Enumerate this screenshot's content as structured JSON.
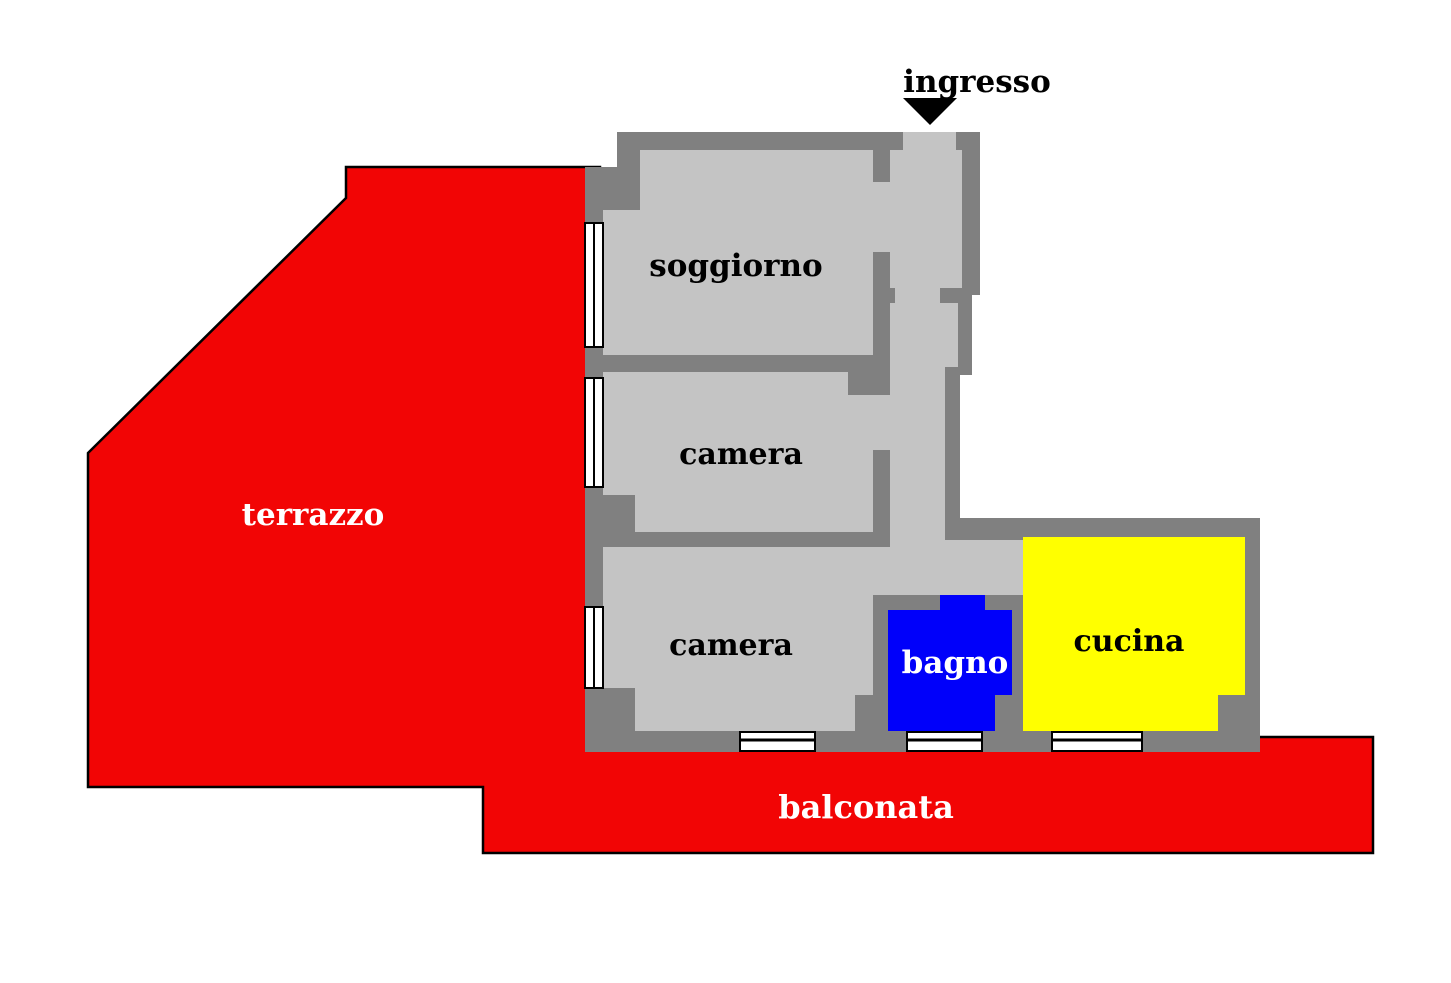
{
  "plan": {
    "title": "apartment floor plan",
    "labels": {
      "ingresso": "ingresso",
      "terrazzo": "terrazzo",
      "soggiorno": "soggiorno",
      "camera1": "camera",
      "camera2": "camera",
      "bagno": "bagno",
      "cucina": "cucina",
      "balconata": "balconata"
    },
    "colors": {
      "terrace_red": "#f20505",
      "wall_gray": "#808080",
      "floor_gray": "#c4c4c4",
      "bagno_blue": "#0000fa",
      "cucina_yellow": "#ffff00",
      "outline_black": "#000000",
      "window_white": "#ffffff",
      "label_white": "#ffffff",
      "label_black": "#000000"
    }
  }
}
